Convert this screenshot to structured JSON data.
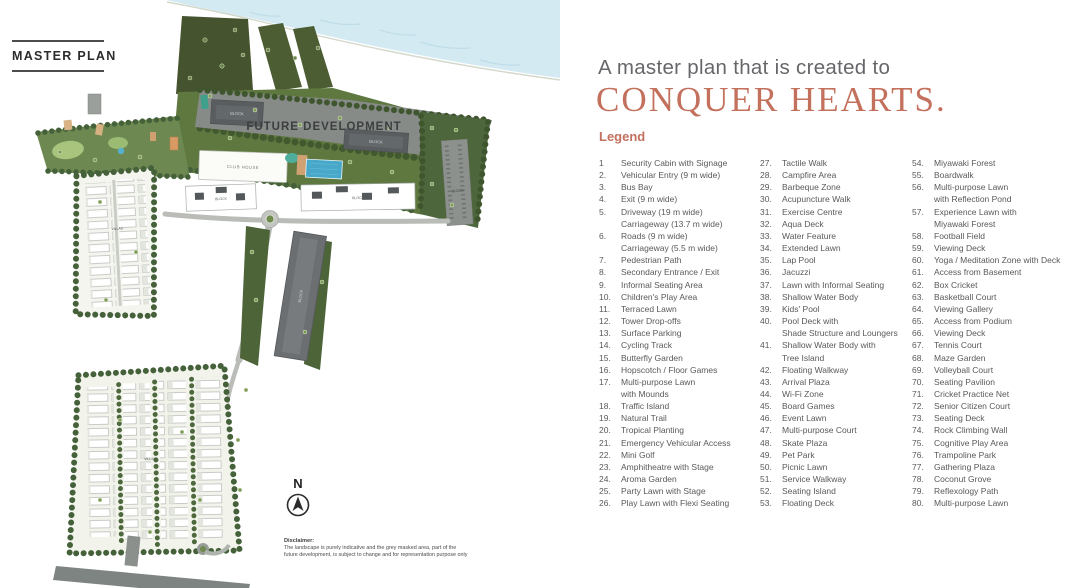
{
  "panel_left": {
    "tag": "MASTER PLAN",
    "map": {
      "future_development": "FUTURE DEVELOPMENT",
      "club_house": "CLUB HOUSE",
      "villas": "VILLAS",
      "block": "BLOCK",
      "compass": "N",
      "disclaimer_heading": "Disclaimer:",
      "disclaimer_line1": "The landscape is purely indicative and the grey masked area, part of the",
      "disclaimer_line2": "future development, is subject to change and for representation purpose only"
    }
  },
  "panel_right": {
    "title_line1": "A master plan that is created to",
    "title_line2": "CONQUER HEARTS.",
    "legend_heading": "Legend",
    "legend": {
      "columns": [
        {
          "items": [
            {
              "num": "1",
              "lines": [
                "Security Cabin with Signage"
              ]
            },
            {
              "num": "2.",
              "lines": [
                "Vehicular Entry (9 m wide)"
              ]
            },
            {
              "num": "3.",
              "lines": [
                "Bus Bay"
              ]
            },
            {
              "num": "4.",
              "lines": [
                "Exit (9 m wide)"
              ]
            },
            {
              "num": "5.",
              "lines": [
                "Driveway (19 m wide)",
                "Carriageway (13.7 m wide)"
              ]
            },
            {
              "num": "6.",
              "lines": [
                "Roads (9 m wide)",
                "Carriageway (5.5 m wide)"
              ]
            },
            {
              "num": "7.",
              "lines": [
                "Pedestrian Path"
              ]
            },
            {
              "num": "8.",
              "lines": [
                "Secondary Entrance / Exit"
              ]
            },
            {
              "num": "9.",
              "lines": [
                "Informal Seating Area"
              ]
            },
            {
              "num": "10.",
              "lines": [
                "Children's Play Area"
              ]
            },
            {
              "num": "11.",
              "lines": [
                "Terraced Lawn"
              ]
            },
            {
              "num": "12.",
              "lines": [
                "Tower Drop-offs"
              ]
            },
            {
              "num": "13.",
              "lines": [
                "Surface Parking"
              ]
            },
            {
              "num": "14.",
              "lines": [
                "Cycling Track"
              ]
            },
            {
              "num": "15.",
              "lines": [
                "Butterfly Garden"
              ]
            },
            {
              "num": "16.",
              "lines": [
                "Hopscotch / Floor Games"
              ]
            },
            {
              "num": "17.",
              "lines": [
                "Multi-purpose Lawn",
                "with Mounds"
              ]
            },
            {
              "num": "18.",
              "lines": [
                "Traffic Island"
              ]
            },
            {
              "num": "19.",
              "lines": [
                "Natural Trail"
              ]
            },
            {
              "num": "20.",
              "lines": [
                "Tropical Planting"
              ]
            },
            {
              "num": "21.",
              "lines": [
                "Emergency Vehicular Access"
              ]
            },
            {
              "num": "22.",
              "lines": [
                "Mini Golf"
              ]
            },
            {
              "num": "23.",
              "lines": [
                "Amphitheatre with Stage"
              ]
            },
            {
              "num": "24.",
              "lines": [
                "Aroma Garden"
              ]
            },
            {
              "num": "25.",
              "lines": [
                "Party Lawn with Stage"
              ]
            },
            {
              "num": "26.",
              "lines": [
                "Play Lawn with Flexi Seating"
              ]
            }
          ]
        },
        {
          "items": [
            {
              "num": "27.",
              "lines": [
                "Tactile Walk"
              ]
            },
            {
              "num": "28.",
              "lines": [
                "Campfire Area"
              ]
            },
            {
              "num": "29.",
              "lines": [
                "Barbeque Zone"
              ]
            },
            {
              "num": "30.",
              "lines": [
                "Acupuncture Walk"
              ]
            },
            {
              "num": "31.",
              "lines": [
                "Exercise Centre"
              ]
            },
            {
              "num": "32.",
              "lines": [
                "Aqua Deck"
              ]
            },
            {
              "num": "33.",
              "lines": [
                "Water Feature"
              ]
            },
            {
              "num": "34.",
              "lines": [
                "Extended Lawn"
              ]
            },
            {
              "num": "35.",
              "lines": [
                "Lap Pool"
              ]
            },
            {
              "num": "36.",
              "lines": [
                "Jacuzzi"
              ]
            },
            {
              "num": "37.",
              "lines": [
                "Lawn with Informal Seating"
              ]
            },
            {
              "num": "38.",
              "lines": [
                "Shallow Water Body"
              ]
            },
            {
              "num": "39.",
              "lines": [
                "Kids' Pool"
              ]
            },
            {
              "num": "40.",
              "lines": [
                "Pool Deck with",
                "Shade Structure and Loungers"
              ]
            },
            {
              "num": "41.",
              "lines": [
                "Shallow Water Body with",
                "Tree Island"
              ]
            },
            {
              "num": "42.",
              "lines": [
                "Floating Walkway"
              ]
            },
            {
              "num": "43.",
              "lines": [
                "Arrival Plaza"
              ]
            },
            {
              "num": "44.",
              "lines": [
                "Wi-Fi Zone"
              ]
            },
            {
              "num": "45.",
              "lines": [
                "Board Games"
              ]
            },
            {
              "num": "46.",
              "lines": [
                "Event Lawn"
              ]
            },
            {
              "num": "47.",
              "lines": [
                "Multi-purpose Court"
              ]
            },
            {
              "num": "48.",
              "lines": [
                "Skate Plaza"
              ]
            },
            {
              "num": "49.",
              "lines": [
                "Pet Park"
              ]
            },
            {
              "num": "50.",
              "lines": [
                "Picnic Lawn"
              ]
            },
            {
              "num": "51.",
              "lines": [
                "Service Walkway"
              ]
            },
            {
              "num": "52.",
              "lines": [
                "Seating Island"
              ]
            },
            {
              "num": "53.",
              "lines": [
                "Floating Deck"
              ]
            }
          ]
        },
        {
          "items": [
            {
              "num": "54.",
              "lines": [
                "Miyawaki Forest"
              ]
            },
            {
              "num": "55.",
              "lines": [
                "Boardwalk"
              ]
            },
            {
              "num": "56.",
              "lines": [
                "Multi-purpose Lawn",
                "with Reflection Pond"
              ]
            },
            {
              "num": "57.",
              "lines": [
                "Experience Lawn with",
                "Miyawaki Forest"
              ]
            },
            {
              "num": "58.",
              "lines": [
                "Football Field"
              ]
            },
            {
              "num": "59.",
              "lines": [
                "Viewing Deck"
              ]
            },
            {
              "num": "60.",
              "lines": [
                "Yoga / Meditation Zone with Deck"
              ]
            },
            {
              "num": "61.",
              "lines": [
                "Access from Basement"
              ]
            },
            {
              "num": "62.",
              "lines": [
                "Box Cricket"
              ]
            },
            {
              "num": "63.",
              "lines": [
                "Basketball Court"
              ]
            },
            {
              "num": "64.",
              "lines": [
                "Viewing Gallery"
              ]
            },
            {
              "num": "65.",
              "lines": [
                "Access from Podium"
              ]
            },
            {
              "num": "66.",
              "lines": [
                "Viewing Deck"
              ]
            },
            {
              "num": "67.",
              "lines": [
                "Tennis Court"
              ]
            },
            {
              "num": "68.",
              "lines": [
                "Maze Garden"
              ]
            },
            {
              "num": "69.",
              "lines": [
                "Volleyball Court"
              ]
            },
            {
              "num": "70.",
              "lines": [
                "Seating Pavilion"
              ]
            },
            {
              "num": "71.",
              "lines": [
                "Cricket Practice Net"
              ]
            },
            {
              "num": "72.",
              "lines": [
                "Senior Citizen Court"
              ]
            },
            {
              "num": "73.",
              "lines": [
                "Seating Deck"
              ]
            },
            {
              "num": "74.",
              "lines": [
                "Rock Climbing Wall"
              ]
            },
            {
              "num": "75.",
              "lines": [
                "Cognitive Play Area"
              ]
            },
            {
              "num": "76.",
              "lines": [
                "Trampoline Park"
              ]
            },
            {
              "num": "77.",
              "lines": [
                "Gathering Plaza"
              ]
            },
            {
              "num": "78.",
              "lines": [
                "Coconut Grove"
              ]
            },
            {
              "num": "79.",
              "lines": [
                "Reflexology Path"
              ]
            },
            {
              "num": "80.",
              "lines": [
                "Multi-purpose Lawn"
              ]
            }
          ]
        }
      ]
    }
  },
  "colors": {
    "accent": "#c3705d",
    "body_text": "#58595a",
    "water": "#d4eaf2",
    "forest_dark": "#46532f",
    "green_mid": "#5f7840",
    "future_grey": "#878b88",
    "building_grey": "#595d5f",
    "pool_blue": "#47a8ca"
  }
}
